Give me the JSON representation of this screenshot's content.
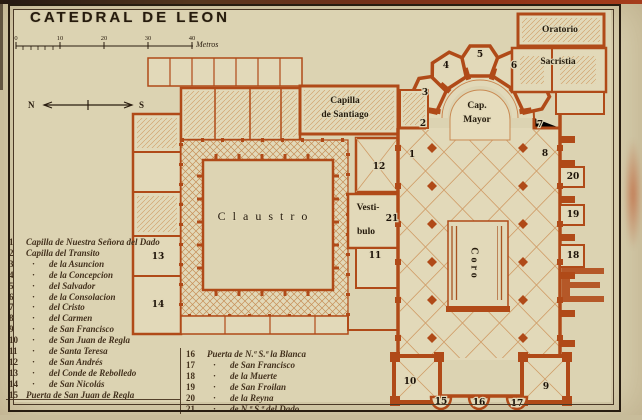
{
  "header": {
    "title": "CATEDRAL DE LEON"
  },
  "scale": {
    "ticks": [
      "0",
      "10",
      "20",
      "30",
      "40"
    ],
    "unit": "Metros"
  },
  "compass": {
    "north": "N",
    "south": "S"
  },
  "plan": {
    "labels": {
      "claustro": "Claustro",
      "capilla_santiago_line1": "Capilla",
      "capilla_santiago_line2": "de Santiago",
      "cap_mayor_line1": "Cap.",
      "cap_mayor_line2": "Mayor",
      "coro": "Coro",
      "vestibulo_line1": "Vesti-",
      "vestibulo_line2": "bulo",
      "oratorio": "Oratorio",
      "sacristia": "Sacristia"
    },
    "markers": [
      "1",
      "2",
      "3",
      "4",
      "5",
      "6",
      "7",
      "8",
      "9",
      "10",
      "11",
      "12",
      "13",
      "14",
      "15",
      "16",
      "17",
      "18",
      "19",
      "20",
      "21"
    ]
  },
  "legend": {
    "col1": [
      {
        "num": "1",
        "mark": "",
        "text": "Capilla de Nuestra Señora del Dado"
      },
      {
        "num": "2",
        "mark": "",
        "text": "Capilla del Transito"
      },
      {
        "num": "3",
        "mark": "·",
        "text": "de la Asuncion"
      },
      {
        "num": "4",
        "mark": "·",
        "text": "de la Concepcion"
      },
      {
        "num": "5",
        "mark": "·",
        "text": "del Salvador"
      },
      {
        "num": "6",
        "mark": "·",
        "text": "de la Consolacion"
      },
      {
        "num": "7",
        "mark": "·",
        "text": "del Cristo"
      },
      {
        "num": "8",
        "mark": "·",
        "text": "del Carmen"
      },
      {
        "num": "9",
        "mark": "·",
        "text": "de San Francisco"
      },
      {
        "num": "10",
        "mark": "·",
        "text": "de San Juan de Regla"
      },
      {
        "num": "11",
        "mark": "·",
        "text": "de Santa Teresa"
      },
      {
        "num": "12",
        "mark": "·",
        "text": "de San Andrés"
      },
      {
        "num": "13",
        "mark": "·",
        "text": "del Conde de Rebolledo"
      },
      {
        "num": "14",
        "mark": "·",
        "text": "de San Nicolás"
      },
      {
        "num": "15",
        "mark": "",
        "text": "Puerta de San Juan de Regla"
      }
    ],
    "col2": [
      {
        "num": "16",
        "mark": "",
        "text": "Puerta de N.ª S.ª la Blanca"
      },
      {
        "num": "17",
        "mark": "·",
        "text": "de San Francisco"
      },
      {
        "num": "18",
        "mark": "·",
        "text": "de la Muerte"
      },
      {
        "num": "19",
        "mark": "·",
        "text": "de San Froilan"
      },
      {
        "num": "20",
        "mark": "·",
        "text": "de la Reyna"
      },
      {
        "num": "21",
        "mark": "·",
        "text": "de N.ª S.ª del Dado"
      }
    ]
  }
}
